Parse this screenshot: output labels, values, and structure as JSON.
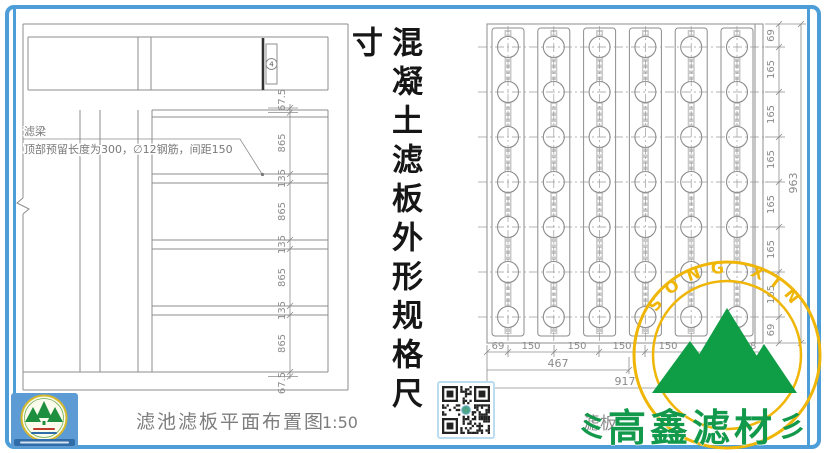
{
  "frame": {
    "color": "#4d9dd8"
  },
  "title_vertical": "混凝土滤板外形规格尺寸",
  "left_drawing": {
    "caption": "滤池滤板平面布置图",
    "scale": "1:50",
    "beam_label": "滤梁",
    "note": "顶部预留长度为300，∅12钢筋，间距150",
    "detail_marker": "4",
    "dims": [
      "67.5",
      "865",
      "135",
      "865",
      "135",
      "865",
      "135",
      "865",
      "67.5"
    ]
  },
  "right_drawing": {
    "caption_partial": "滤板",
    "grid": {
      "columns": 6,
      "rows": 7
    },
    "dims_right": [
      "69",
      "165",
      "165",
      "165",
      "165",
      "165",
      "165",
      "69"
    ],
    "dim_height_total": "963",
    "dims_bottom": [
      "69",
      "150",
      "150",
      "150",
      "150",
      "150",
      "98"
    ],
    "dim_width_partial": "467",
    "dim_width_total": "917"
  },
  "watermark": {
    "arc_text": "SONG XIN",
    "brand_text": "高鑫滤材",
    "ring_color": "#efb608",
    "mountain_color": "#0f9d45",
    "brand_color": "#12994b"
  },
  "icons": {
    "qr": "qr-code-icon",
    "logo": "company-seal-icon",
    "flourish": "wave-flourish-icon"
  }
}
